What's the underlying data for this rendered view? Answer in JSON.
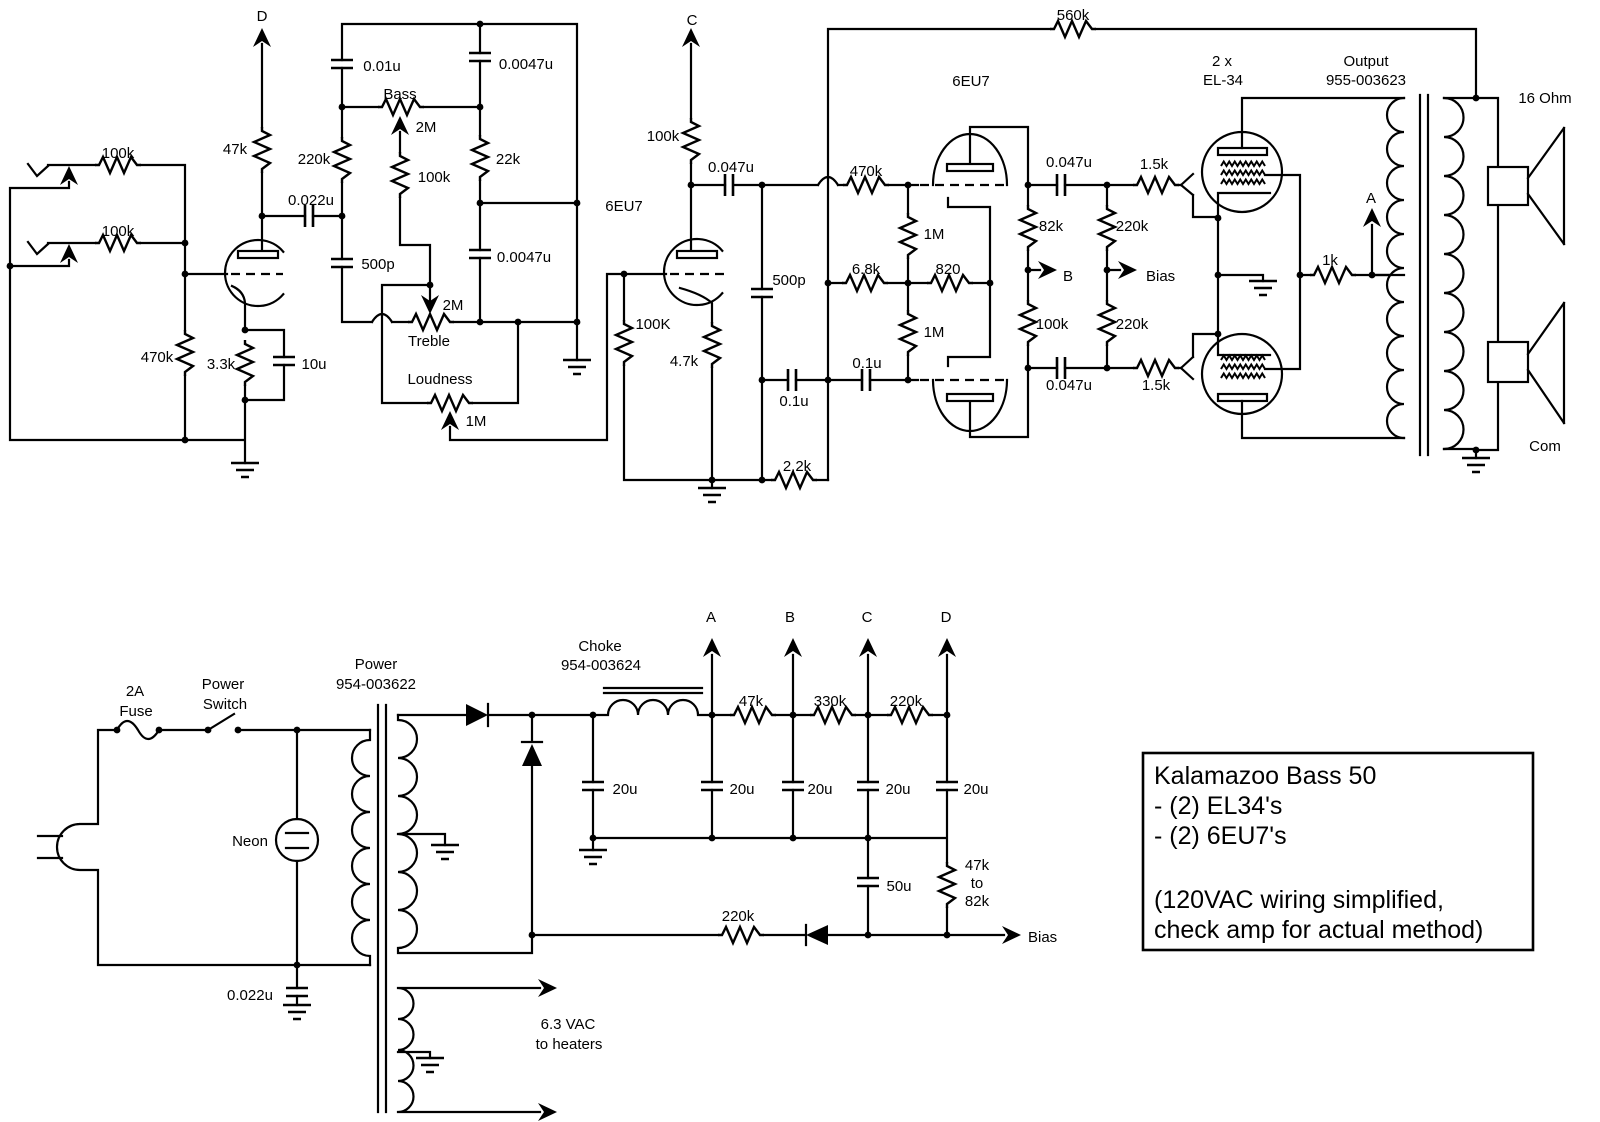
{
  "title": "Kalamazoo Bass 50 tube amplifier schematic",
  "colors": {
    "line": "#000000",
    "background": "#ffffff"
  },
  "preamp": {
    "in_r1": "100k",
    "in_r2": "100k",
    "grid_r": "470k",
    "plate_r": "47k",
    "supply_d": "D",
    "cathode_r": "3.3k",
    "cathode_c": "10u",
    "coupling_c": "0.022u"
  },
  "tone": {
    "c1": "0.01u",
    "c2": "0.0047u",
    "bass": "Bass",
    "bass_v": "2M",
    "mid_r": "100k",
    "r22k": "22k",
    "c500p": "500p",
    "c3": "0.0047u",
    "treble": "Treble",
    "treble_v": "2M",
    "r220k": "220k",
    "loud": "Loudness",
    "loud_v": "1M"
  },
  "stage2": {
    "tube": "6EU7",
    "supply_c": "C",
    "plate_r": "100k",
    "coupling_c": "0.047u",
    "grid_r": "100K",
    "cathode_r": "4.7k",
    "c500p": "500p",
    "c01a": "0.1u",
    "c01b": "0.1u",
    "r22": "2.2k"
  },
  "inverter": {
    "tube": "6EU7",
    "r470k": "470k",
    "r1m_a": "1M",
    "r1m_b": "1M",
    "r68": "6.8k",
    "r820": "820",
    "r82k": "82k",
    "r100k": "100k",
    "b_tap": "B",
    "bias_tap": "Bias",
    "r220k_a": "220k",
    "r220k_b": "220k",
    "c_a": "0.047u",
    "c_b": "0.047u",
    "fb": "560k"
  },
  "output": {
    "qty": "2 x",
    "tube": "EL-34",
    "gs_a": "1.5k",
    "gs_b": "1.5k",
    "screen_r": "1k",
    "a_tap": "A",
    "ot_name": "Output",
    "ot_part": "955-003623",
    "tap16": "16 Ohm",
    "com": "Com"
  },
  "supply": {
    "fuse1": "2A",
    "fuse2": "Fuse",
    "sw1": "Power",
    "sw2": "Switch",
    "neon": "Neon",
    "line_c": "0.022u",
    "pt_name": "Power",
    "pt_part": "954-003622",
    "ch_name": "Choke",
    "ch_part": "954-003624",
    "tap_a": "A",
    "tap_b": "B",
    "tap_c": "C",
    "tap_d": "D",
    "r47k": "47k",
    "r330k": "330k",
    "r220k": "220k",
    "c20_1": "20u",
    "c20_2": "20u",
    "c20_3": "20u",
    "c20_4": "20u",
    "c20_5": "20u",
    "c50u": "50u",
    "br1": "47k",
    "br2": "to",
    "br3": "82k",
    "bias_r": "220k",
    "bias_out": "Bias",
    "heat1": "6.3 VAC",
    "heat2": "to heaters"
  },
  "info_box": {
    "line1": "Kalamazoo Bass 50",
    "line2": "- (2) EL34's",
    "line3": "- (2) 6EU7's",
    "line4": "(120VAC wiring simplified,",
    "line5": "check amp for actual method)"
  }
}
